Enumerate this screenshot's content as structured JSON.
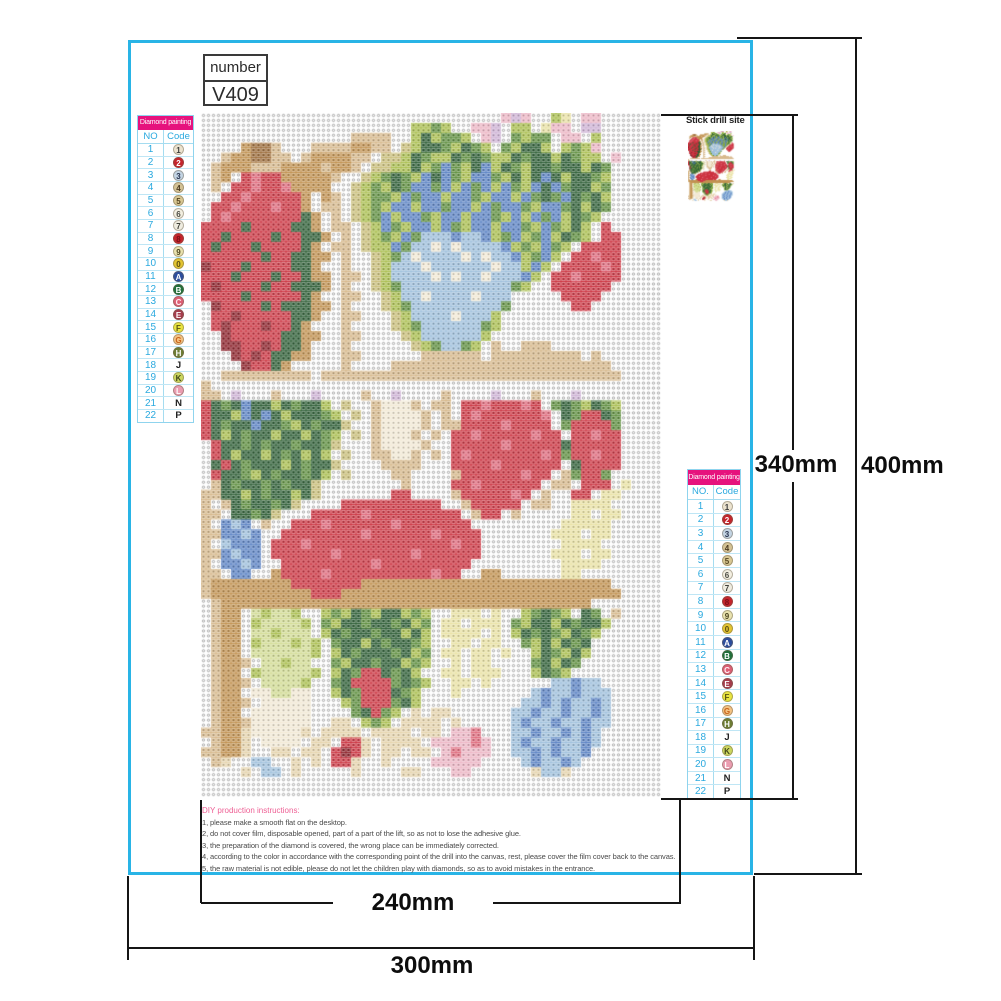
{
  "number_box": {
    "label": "number",
    "value": "V409"
  },
  "legend": {
    "title": "Diamond painting",
    "no_label_left": "NO",
    "no_label_right": "NO.",
    "code_label": "Code",
    "header_bg": "#e6127d",
    "accent": "#2aa9df",
    "rows": [
      {
        "no": "1",
        "code": "1",
        "bg": "#ece3cf",
        "fg": "#3c3c3c",
        "circle": true
      },
      {
        "no": "2",
        "code": "2",
        "bg": "#c5242c",
        "fg": "#ffffff",
        "circle": true
      },
      {
        "no": "3",
        "code": "3",
        "bg": "#c3d4e3",
        "fg": "#2a3550",
        "circle": true
      },
      {
        "no": "4",
        "code": "4",
        "bg": "#d4c294",
        "fg": "#4a3a20",
        "circle": true
      },
      {
        "no": "5",
        "code": "5",
        "bg": "#d9c893",
        "fg": "#554420",
        "circle": true
      },
      {
        "no": "6",
        "code": "6",
        "bg": "#f3efe1",
        "fg": "#4c4c44",
        "circle": true
      },
      {
        "no": "7",
        "code": "7",
        "bg": "#efece0",
        "fg": "#3e3e38",
        "circle": true
      },
      {
        "no": "8",
        "code": "8",
        "bg": "#c5242c",
        "fg": "#7a1118",
        "circle": true
      },
      {
        "no": "9",
        "code": "9",
        "bg": "#e9e2ae",
        "fg": "#4c4520",
        "circle": true
      },
      {
        "no": "10",
        "code": "0",
        "bg": "#e4c531",
        "fg": "#584b12",
        "circle": true
      },
      {
        "no": "11",
        "code": "A",
        "bg": "#2c4d9e",
        "fg": "#ffffff",
        "circle": true
      },
      {
        "no": "12",
        "code": "B",
        "bg": "#20703a",
        "fg": "#ffffff",
        "circle": true
      },
      {
        "no": "13",
        "code": "C",
        "bg": "#dd5f75",
        "fg": "#ffeef2",
        "circle": true
      },
      {
        "no": "14",
        "code": "E",
        "bg": "#a63c4c",
        "fg": "#ffffff",
        "circle": true
      },
      {
        "no": "15",
        "code": "F",
        "bg": "#e9e43f",
        "fg": "#5a5413",
        "circle": true
      },
      {
        "no": "16",
        "code": "G",
        "bg": "#f4c383",
        "fg": "#c7641c",
        "circle": true
      },
      {
        "no": "17",
        "code": "H",
        "bg": "#6d7d33",
        "fg": "#ffffff",
        "circle": true
      },
      {
        "no": "18",
        "code": "J",
        "bg": "",
        "fg": "#222222",
        "circle": false
      },
      {
        "no": "19",
        "code": "K",
        "bg": "#ccd75e",
        "fg": "#40451a",
        "circle": true
      },
      {
        "no": "20",
        "code": "L",
        "bg": "#ea9cb0",
        "fg": "#ffffff",
        "circle": true
      },
      {
        "no": "21",
        "code": "N",
        "bg": "",
        "fg": "#222222",
        "circle": false
      },
      {
        "no": "22",
        "code": "P",
        "bg": "",
        "fg": "#222222",
        "circle": false
      }
    ]
  },
  "stick_drill": {
    "label": "Stick drill site"
  },
  "instructions": {
    "title": "DIY production instructions:",
    "lines": [
      "1, please make a smooth flat on the desktop.",
      "2, do not cover film, disposable opened, part of a part of the lift, so as not to lose the adhesive glue.",
      "3, the preparation of the diamond is covered, the wrong place can be immediately corrected.",
      "4, according to the color in accordance with the corresponding point of the drill into the canvas, rest, please cover the film cover back to the canvas.",
      "5, the raw material is not edible, please do not let the children play with diamonds, so as to avoid mistakes in the entrance."
    ]
  },
  "dimensions": {
    "width_inner": "240mm",
    "width_outer": "300mm",
    "height_inner": "340mm",
    "height_outer": "400mm"
  },
  "mosaic": {
    "cols": 46,
    "rows": 69,
    "palette": {
      ".": "#ffffff",
      "W": "#f3ead6",
      "s": "#e2e2e2",
      "t": "#d7b98c",
      "T": "#9c6b38",
      "w": "#c1914f",
      "f": "#e7d5ae",
      "k": "#cabf7a",
      "o": "#db9a4b",
      "r": "#cc3340",
      "R": "#8c1f28",
      "m": "#e06a7c",
      "p": "#eeb7c6",
      "l": "#cfb3d6",
      "e": "#eae3a5",
      "y": "#aabf4e",
      "Y": "#d3dd95",
      "g": "#5e8f3e",
      "G": "#2d5e35",
      "c": "#9fc0dd",
      "b": "#5a82c4",
      "B": "#2d4f9e"
    },
    "grid": [
      "..............................plp..ye.pp......",
      ".....................yygy..ppl.yy.epp.ll......",
      "...............tttt..yGyggy.pl.gygg.pp.y......",
      "....wTTt...ttttwwtt.kyGGgyGgy.gyGGy.ygyp......",
      "..twwTTtt.twwwwtt.kkyGgyyGgGgyyGgGGyGgyy.p....",
      ".twwwtttwwwwtwwt.kkyyGygbgyGbyGgyGGgGGyGg.....",
      ".tw.rmrrwwwwwt..kygGgybGbgybbgyGyGbGyGGgy.....",
      ".t.rrmrrmwwww..kygyGgbbgbybgbybgybGbgGGyg.....",
      "..rrmrrrrrw.wt.kyggybgbbybbgybbybgGgbGgGy.....",
      ".rrmrrrmrrw.tt.kygybbybbgbbybgbbgybbgGyGg.....",
      ".rmrrrrrrrGw.t.kygbybbgybbybbgybybgbyGgy......",
      "rrrrGrrrrGGw.tt.kybgybbybgybbybbgybgyGy.r.....",
      "rrGrrrrGrrGGw.t.kygybgcccbccbygbygbyGgy.rr....",
      "rGrrrGrrrrGw.tt.kyybgccWcWccccbygybgy.rrrr....",
      "rrrrrrGrrGGww.t..kygcWccccWcWccbygby.rrmrr....",
      "RrrrGrrrrGGw..t..kycccWccccccWccyby.rrrrmr....",
      "rrrGrrrGrrGww.tt.kyccccWcWccWcccby.rrmrrrr....",
      "rRrrrrGrrGGGw.t..kygcccccccccccgy..rrrrrr.....",
      "rrrrGrrrrrGw..tt..kyccWccccWccc.....rrrr......",
      ".RrrrrGrGGGww.t...kygcccccccccg......rr.......",
      ".rrRrrrrrGGw..tt...kyccccWcccy................",
      ".rRrrrRrrGw...t....kygccccccgy................",
      "..RrrrrrGGww..tt....kyccccccy.................",
      "..RRrrRrGGw...t......kygccgy.t..ttt...........",
      "...RrRrGGww...tt......tttttt.ttttttttt.t......",
      "....RrrGw.....t....tttttttttttttttttttttt.....",
      "..ttttttttt.tttttttttttttttttttttttttttttt....",
      "t.............................................",
      "tt.l...t...l....t..l....t....l...t...l........",
      "rGgGbGGyGgGGy.k..tWWWt.tt.rrmrrrmr.gGgyGgy....",
      "rGGybGbGyGGGgy.k.tWWWWt.t.rmrrrrrrm.GgrrGg....",
      "rGgGGbGGgyGgGGk..tWWWWt.ttrrrrmrrrr.grrrrg....",
      "rGyGgGGyGGyGgy.k.tWWWt.t.rrmrrrrrmrr.rrmrr....",
      ".rGGgGgGGgGGgk...tWWWWt..rrrrrmrrrrrGrrrrr....",
      ".rGyGGyGgGyGy.k..ttWWt.t.rmrrrrrrrmrgrrmrr....",
      ".GrGgGGGyGgGGk....tttt...rrrrmrrrrrr.Grrrr....",
      ".rGGgyGgGGgGy.k....tt....trrrrrrmrr.tgrrg.....",
      ".tGgGGgGgGGk........t....rrmrrrrrr.tt.rrr.e...",
      "ttGGyGgGGyGk.......rr....trrrrrmr.t..rr.ee....",
      "t.tGgGGgGk....rrrrrrrrrr..trrrrr.tt..eeee.....",
      "tt.GGgGk...rrrrrmrrrrrrrrr.trr.t.....ee.ee....",
      "t.bcb.t..rrrmrrrrrrmrrrrrrr.........eeeee.....",
      "ttbbcb..rrrrrrrrmrrrrrrmrrrr.......eee.ee.....",
      "t.cbbb.rrrmrrrrrrrrrrrrrrmrr........eeee......",
      "ttbcbb.rrrrrrmrrrrrrrmrrrrrr.......eee.ee.....",
      "t.bbcb..rrrrrrrrrmrrrrrrrrr.........eeee......",
      "tt.bb..wrrrrmrrrrrrrrrrmrr..ww......ee........",
      "twwwwwwwwrrrrrrrwwwwwwwwwwwwwwwwwwwwwwwww....",
      "twwwwwwwwwwrrrwwwwwwwwwwwwwwwwwwwwwwwwwwww...",
      ".twwwwwwwwwwwwwwwwwwwwwwwwwwwwwwwwwwwww......",
      ".tww.YyYYy..ygyGgyGGygy..eee.e..ygGgy.Gg.t....",
      ".tww.yYYYYy.gyGGgGGgGyg.ee.eee.gyGGyGgGGy.....",
      ".tww.YYyYYY.yGgGGgGGyGy.eeee.e.yGgGgyGgy......",
      ".tww.yYYYyYy.gGGyGgGGgy..ee.ee..gyGyGgG.......",
      ".tww.YYYYYYy.yGgGGGgGyg.ee.ee.e..yGgyGy.......",
      ".twwt.YYyYY..gyGGgGGygy..e.ee....gGyGg........",
      ".tww.yYYYYYy.yGgrrGgGy..ee.eee...yGgy.........",
      ".twwt.YYYYy..gGrrrrgGgy..ee.e......ccbcc......",
      ".tww.WWYYWW..yGgrrrGgy...e.......cbccbccc.....",
      ".twwt.WWWWW...ygrrrgGy..........ccbcbccbc.....",
      ".tww.WWWWWW....gGrgy.f.ff......ccbccbccbc.....",
      ".twwtWWWWWW..ff.ygy.ffff.f.....cbccbccbcc.....",
      "ttwwfWWWWWf.ffff.ffff.ff.ppm...ccbccbcbc......",
      ".twwf.WWWW.ff.rrf.ffff.ppppmp..cbccbccbc......",
      "ttwwf..ff.ff.rRrf.ff.ff.pmppp..ccbcbccb.......",
      ".tf..cc..f.f.rrf..f....ppppp....cbccbc........",
      "....f.cc.f.....f....ff...pp......fccf.........",
      "..............................................",
      ".............................................."
    ]
  }
}
